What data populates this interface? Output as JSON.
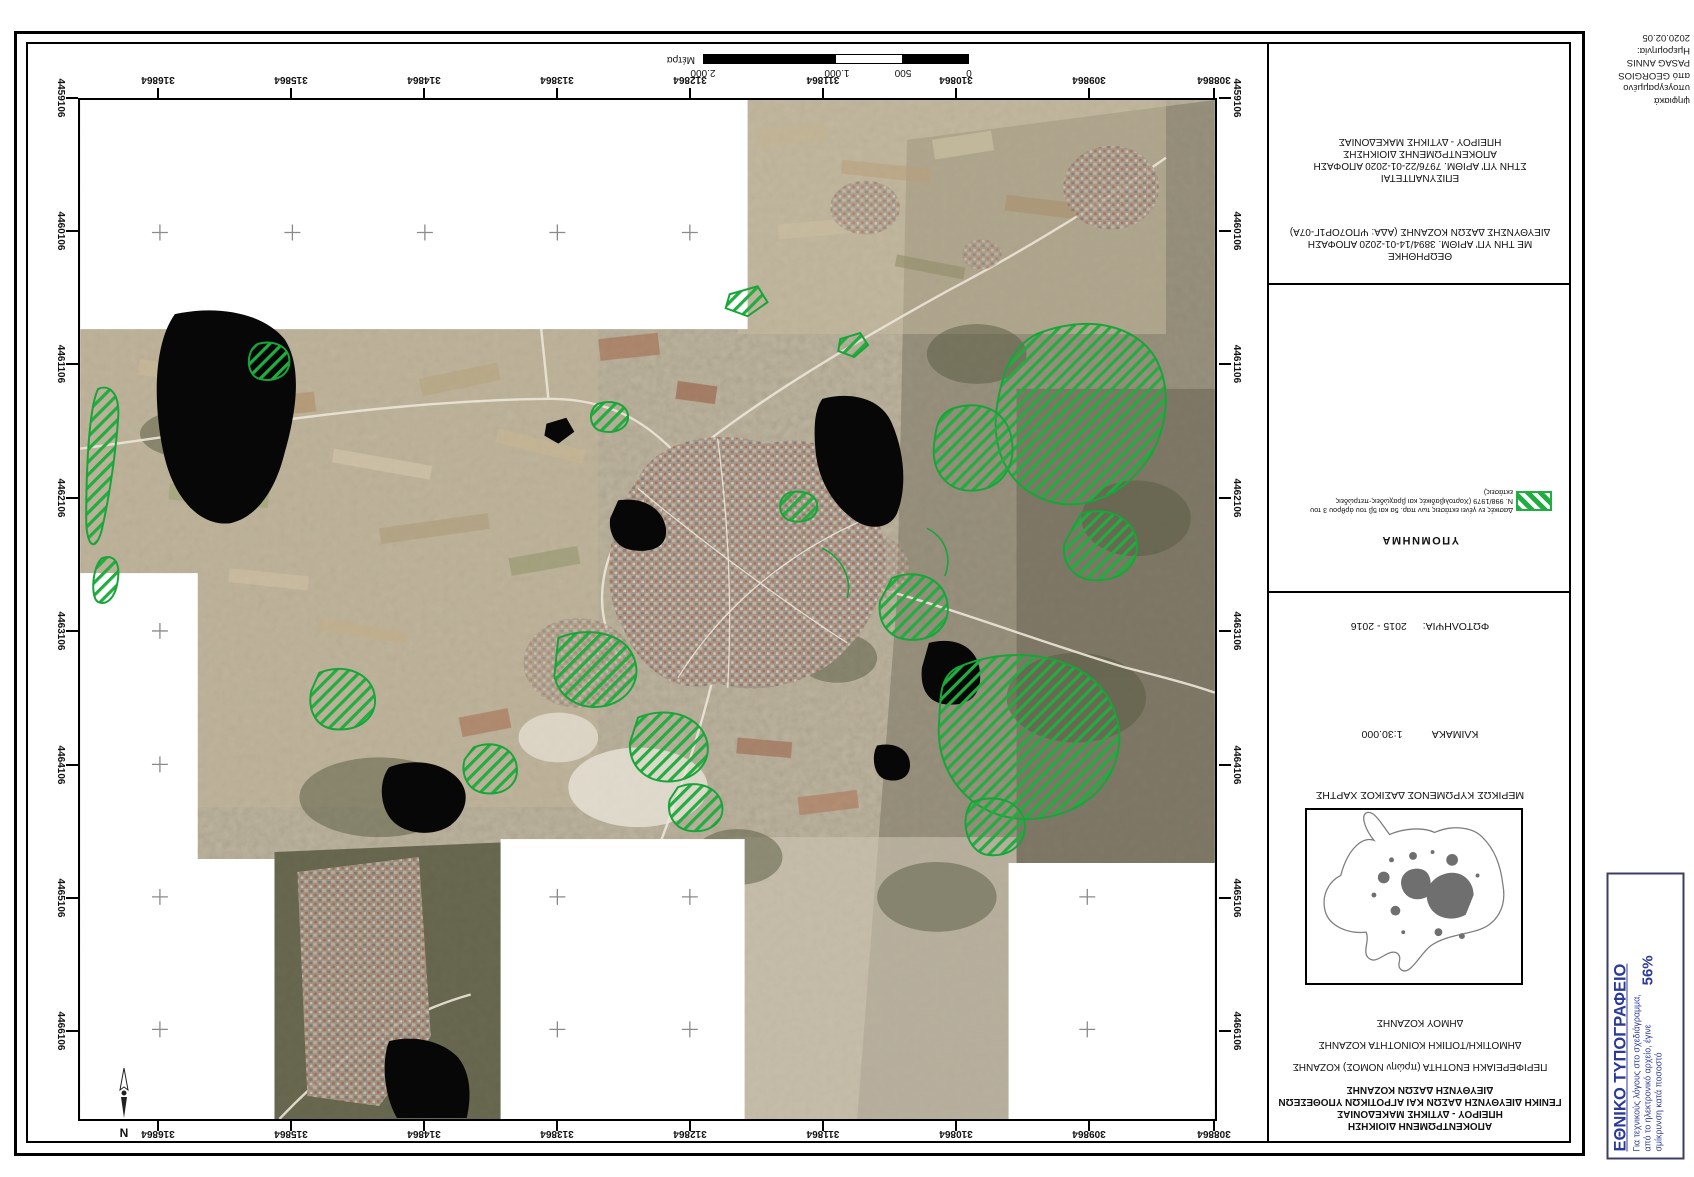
{
  "map": {
    "eastings": [
      "316864",
      "315864",
      "314864",
      "313864",
      "312864",
      "311864",
      "310864",
      "309864",
      "308864"
    ],
    "northings": [
      "4459106",
      "4460106",
      "4461106",
      "4462106",
      "4463106",
      "4464106",
      "4465106",
      "4466106"
    ],
    "scalebar": {
      "labels": [
        "0",
        "500",
        "1.000",
        "2.000"
      ],
      "unit": "Μέτρα"
    },
    "north_label": "N",
    "legend_green": "#1fae3f"
  },
  "panel": {
    "org_lines": [
      "ΑΠΟΚΕΝΤΡΩΜΕΝΗ ΔΙΟΙΚΗΣΗ",
      "ΗΠΕΙΡΟΥ - ΔΥΤΙΚΗΣ ΜΑΚΕΔΟΝΙΑΣ",
      "ΓΕΝΙΚΗ ΔΙΕΥΘΥΝΣΗ ΔΑΣΩΝ ΚΑΙ ΑΓΡΟΤΙΚΩΝ ΥΠΟΘΕΣΕΩΝ",
      "ΔΙΕΥΘΥΝΣΗ ΔΑΣΩΝ ΚΟΖΑΝΗΣ"
    ],
    "region_unit": "ΠΕΡΙΦΕΡΕΙΑΚΗ ΕΝΟΤΗΤΑ (πρώην ΝΟΜΟΣ) ΚΟΖΑΝΗΣ",
    "community": "ΔΗΜΟΤΙΚΗ/ΤΟΠΙΚΗ ΚΟΙΝΟΤΗΤΑ ΚΟΖΑΝΗΣ",
    "municipality": "ΔΗΜΟΥ ΚΟΖΑΝΗΣ",
    "inset_caption": "ΜΕΡΙΚΩΣ ΚΥΡΩΜΕΝΟΣ ΔΑΣΙΚΟΣ ΧΑΡΤΗΣ",
    "scale_label": "ΚΛΙΜΑΚΑ",
    "scale_value": "1:30.000",
    "photo_label": "ΦΩΤΟΛΗΨΙΑ:",
    "photo_value": "2015 - 2016",
    "legend_title": "ΥΠΟΜΝΗΜΑ",
    "legend_lines": [
      "Δασικές εν γένει εκτάσεις των παρ. 5α και 5β του άρθρου 3 του",
      "Ν. 998/1979 (Χορτολιβαδικές και βραχώδεις-πετρώδεις",
      "εκτάσεις)"
    ],
    "approved_title": "ΘΕΩΡΗΘΗΚΕ",
    "approved_line1": "ΜΕ ΤΗΝ ΥΠ' ΑΡΙΘΜ. 3894/14-01-2020 ΑΠΟΦΑΣΗ",
    "approved_line2": "ΔΙΕΥΘΥΝΣΗΣ ΔΑΣΩΝ ΚΟΖΑΝΗΣ (ΑΔΑ: ΨΠΟ7ΟΡ1Γ-07Α)",
    "attached_title": "ΕΠΙΣΥΝΑΠΤΕΤΑΙ",
    "attached_line1": "ΣΤΗΝ ΥΠ' ΑΡΙΘΜ. 7976/22-01-2020 ΑΠΟΦΑΣΗ",
    "attached_line2": "ΑΠΟΚΕΝΤΡΩΜΕΝΗΣ ΔΙΟΙΚΗΣΗΣ",
    "attached_line3": "ΗΠΕΙΡΟΥ - ΔΥΤΙΚΗΣ ΜΑΚΕΔΟΝΙΑΣ"
  },
  "signature": {
    "lines": [
      "ψηφιακά",
      "υπογεγραμμένο",
      "από GEORGIOS",
      "PASAG ANNIS",
      "Ημερομηνία:",
      "2020.02.05"
    ]
  },
  "stamp": {
    "title": "ΕΘΝΙΚΟ ΤΥΠΟΓΡΑΦΕΙΟ",
    "line1": "Για τεχνικούς λόγους στο σχεδιάγραμμα,",
    "line2": "από το ηλεκτρονικό αρχείο, έγινε",
    "line3": "σμίκρυνση κατά ποσοστό",
    "percent": "56%",
    "color": "#2b3a9a"
  }
}
